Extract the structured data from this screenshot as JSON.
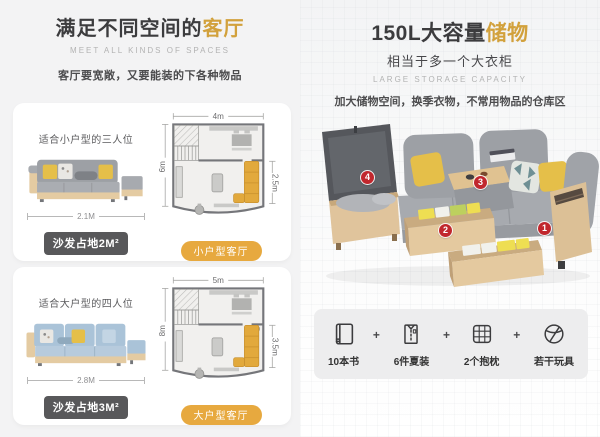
{
  "left": {
    "title_prefix": "满足不同空间的",
    "title_accent": "客厅",
    "subtitle_en": "MEET ALL KINDS OF SPACES",
    "description": "客厅要宽敞，又要能装的下各种物品",
    "cards": [
      {
        "fit_label": "适合小户型的三人位",
        "sofa_width": "2.1M",
        "area_badge": "沙发占地2M²",
        "plan": {
          "width": "4m",
          "height": "6m",
          "sofa_len": "2.5m"
        },
        "room_tag": "小户型客厅"
      },
      {
        "fit_label": "适合大户型的四人位",
        "sofa_width": "2.8M",
        "area_badge": "沙发占地3M²",
        "plan": {
          "width": "5m",
          "height": "8m",
          "sofa_len": "3.5m"
        },
        "room_tag": "大户型客厅"
      }
    ]
  },
  "right": {
    "title_prefix": "150L大容量",
    "title_accent": "储物",
    "subtitle": "相当于多一个大衣柜",
    "subtitle_en": "LARGE STORAGE CAPACITY",
    "description": "加大储物空间，换季衣物，不常用物品的仓库区",
    "markers": [
      "1",
      "2",
      "3",
      "4"
    ],
    "plus_sign": "+",
    "capacity_items": [
      {
        "icon": "book-icon",
        "label": "10本书"
      },
      {
        "icon": "shirt-icon",
        "label": "6件夏装"
      },
      {
        "icon": "pillow-icon",
        "label": "2个抱枕"
      },
      {
        "icon": "ball-icon",
        "label": "若干玩具"
      }
    ]
  },
  "colors": {
    "accent": "#d2a13c",
    "tag_bg": "#e7a93f",
    "badge_bg": "#58585a",
    "marker_red": "#c1272d",
    "text_dark": "#3c3c3e",
    "text_gray": "#b3b3b3"
  }
}
